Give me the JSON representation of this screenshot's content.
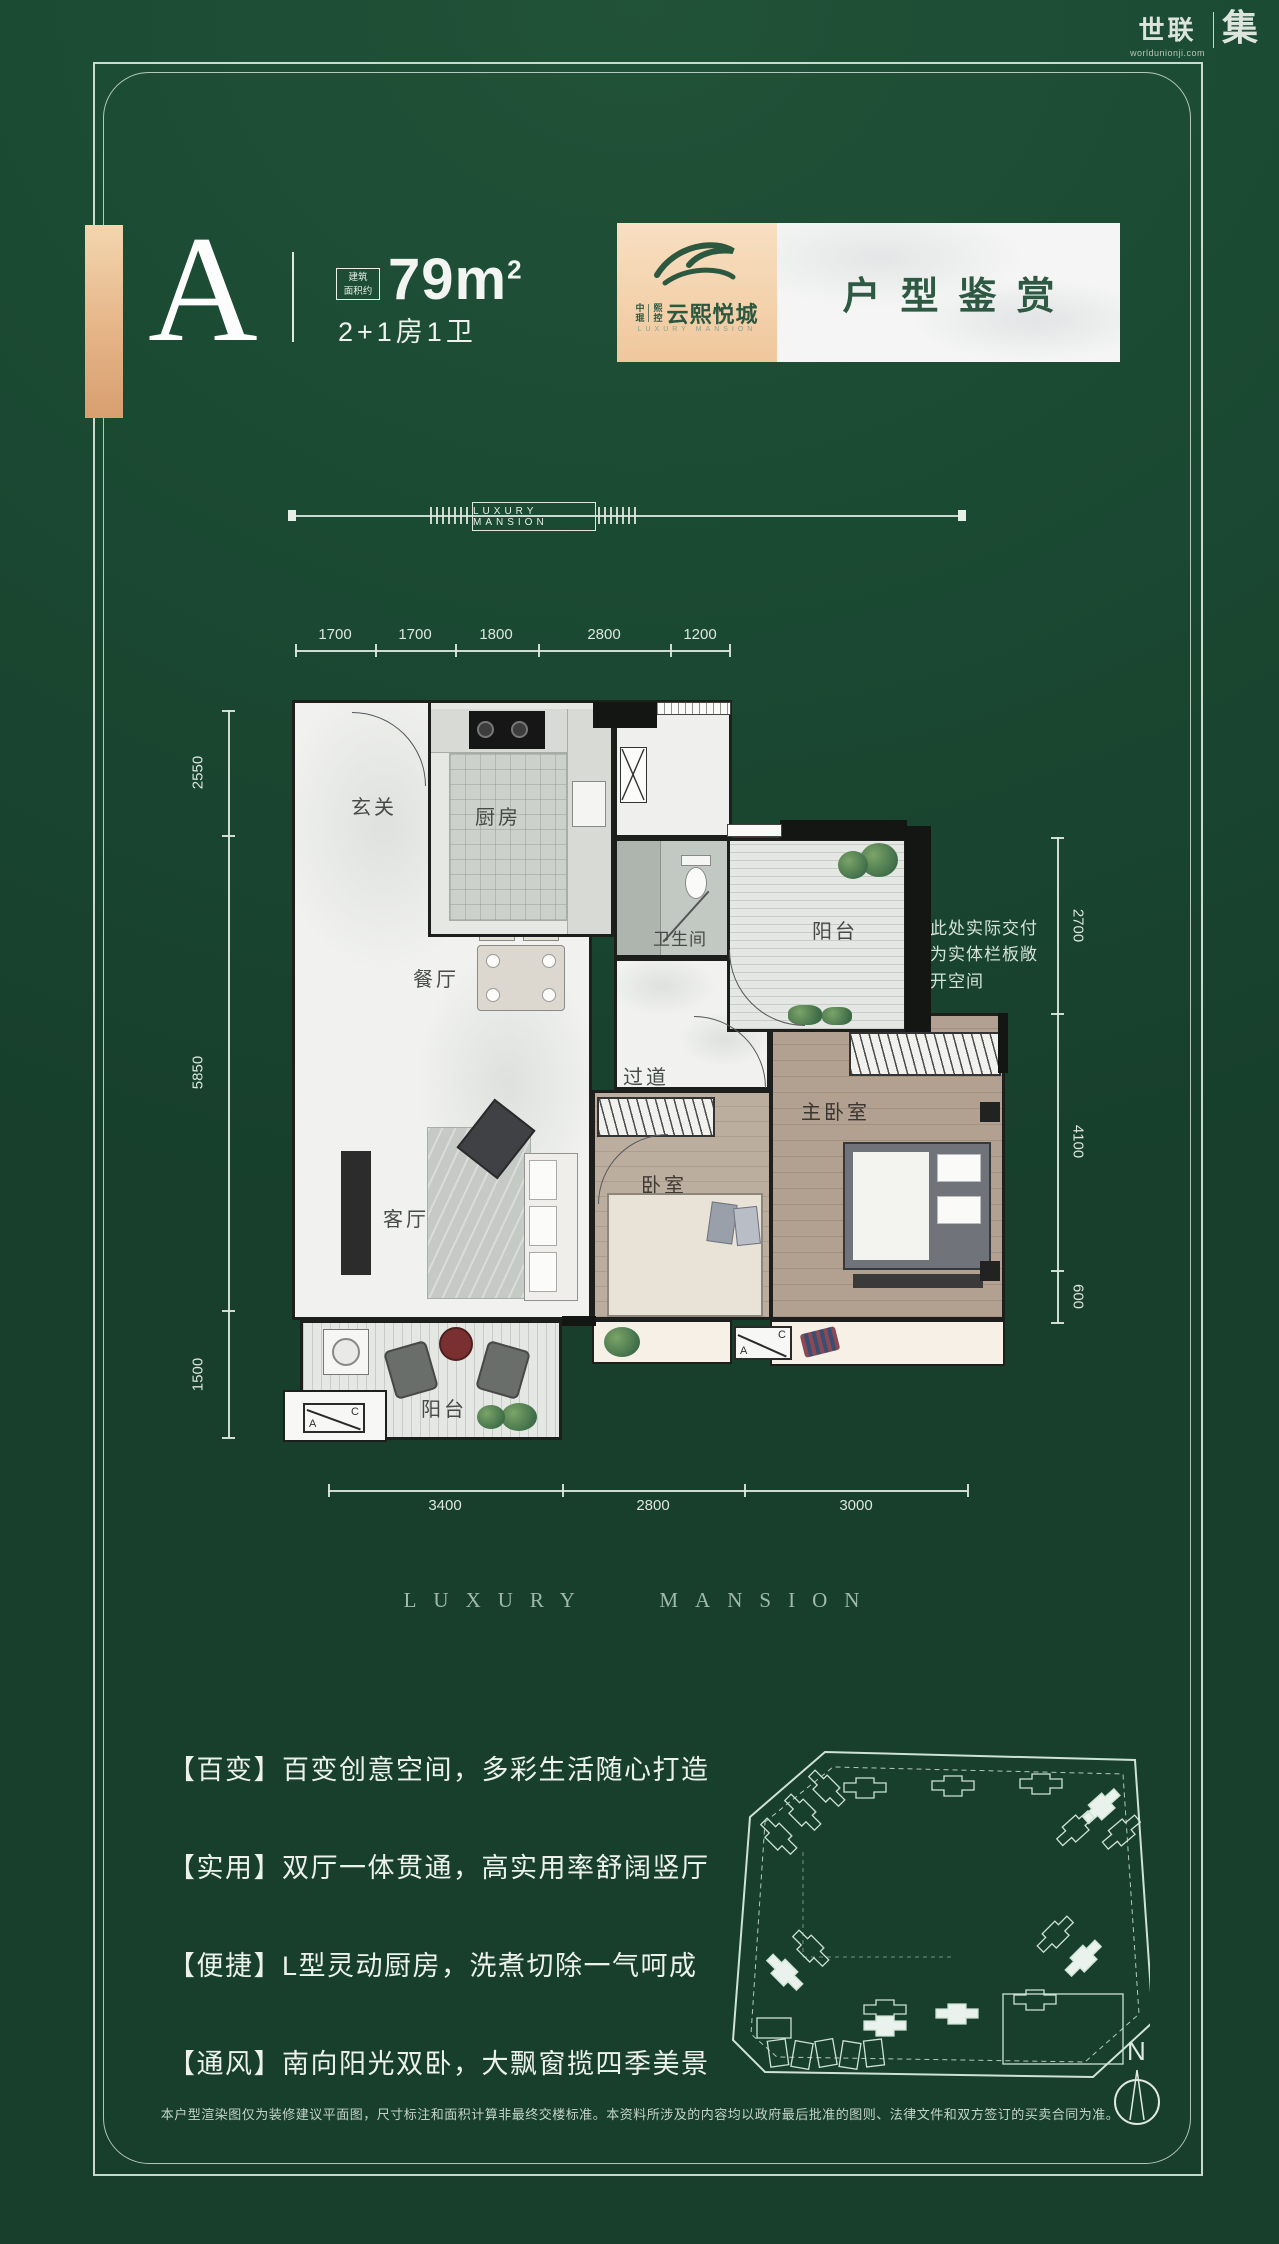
{
  "brand": {
    "name": "世联",
    "url": "worldunionji.com",
    "suffix": "集"
  },
  "header": {
    "unit": "A",
    "area_label_l1": "建筑",
    "area_label_l2": "面积约",
    "area_value": "79m",
    "area_sup": "2",
    "layout": "2+1房1卫",
    "banner_title": "户型鉴赏",
    "logo": {
      "c1": "中",
      "c2": "琨",
      "c3": "熙",
      "c4": "控",
      "project": "云熙悦城",
      "sub": "LUXURY MANSION"
    }
  },
  "divider": {
    "label": "LUXURY MANSION"
  },
  "plan": {
    "rooms": {
      "entry": "玄关",
      "kitchen": "厨房",
      "dining": "餐厅",
      "bath": "卫生间",
      "balcony_top": "阳台",
      "hallway": "过道",
      "master": "主卧室",
      "bedroom": "卧室",
      "living": "客厅",
      "balcony_bottom": "阳台"
    },
    "note_l1": "此处实际交付",
    "note_l2": "为实体栏板敞",
    "note_l3": "开空间",
    "ac": {
      "a": "A",
      "c": "C"
    },
    "dims": {
      "top": [
        "1700",
        "1700",
        "1800",
        "2800",
        "1200"
      ],
      "left": [
        "2550",
        "5850",
        "1500"
      ],
      "right": [
        "2700",
        "4100",
        "600"
      ],
      "bottom": [
        "3400",
        "2800",
        "3000"
      ]
    }
  },
  "watermark": "LUXURY MANSION",
  "features": [
    "【百变】百变创意空间，多彩生活随心打造",
    "【实用】双厅一体贯通，高实用率舒阔竖厅",
    "【便捷】L型灵动厨房，洗煮切除一气呵成",
    "【通风】南向阳光双卧，大飘窗揽四季美景"
  ],
  "siteplan": {
    "compass": "N"
  },
  "disclaimer": "本户型渲染图仅为装修建议平面图，尺寸标注和面积计算非最终交楼标准。本资料所涉及的内容均以政府最后批准的图则、法律文件和双方签订的买卖合同为准。",
  "colors": {
    "background": "#1b4a33",
    "accent_tan": "#e5b487",
    "banner_green": "#2e5943",
    "line": "#dfe8e0"
  }
}
